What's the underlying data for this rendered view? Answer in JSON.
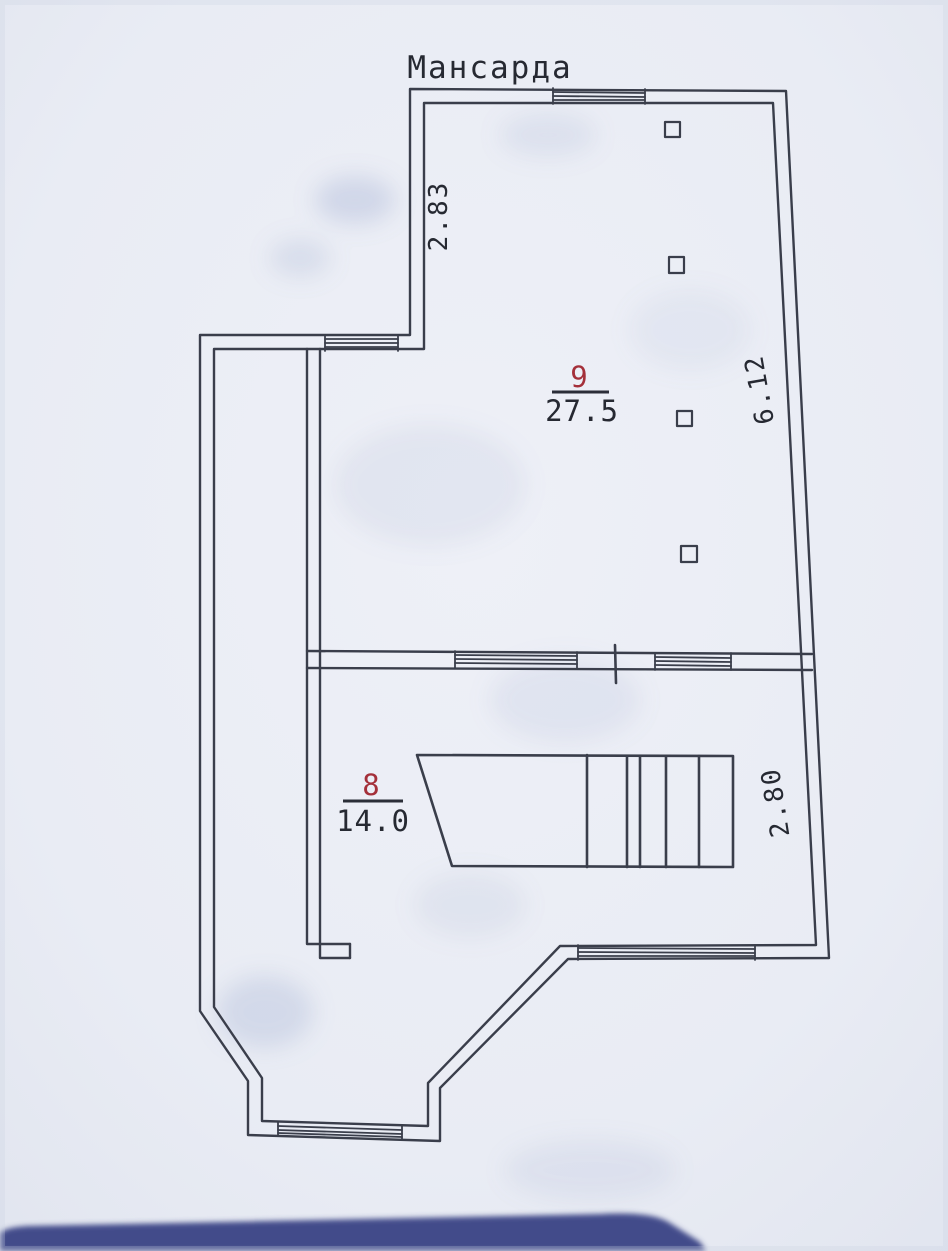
{
  "document": {
    "title": "Мансарда"
  },
  "rooms": [
    {
      "number": "9",
      "area": "27.5"
    },
    {
      "number": "8",
      "area": "14.0"
    }
  ],
  "dimensions": {
    "upper_left_wall": "2.83",
    "right_wall_upper": "6.12",
    "right_wall_lower": "2.80"
  },
  "colors": {
    "ink": "#3a3e4b",
    "text": "#262932",
    "room_number_red": "#a4303a",
    "paper": "#e9ecf4",
    "bottom_bar": "#424c8a"
  }
}
